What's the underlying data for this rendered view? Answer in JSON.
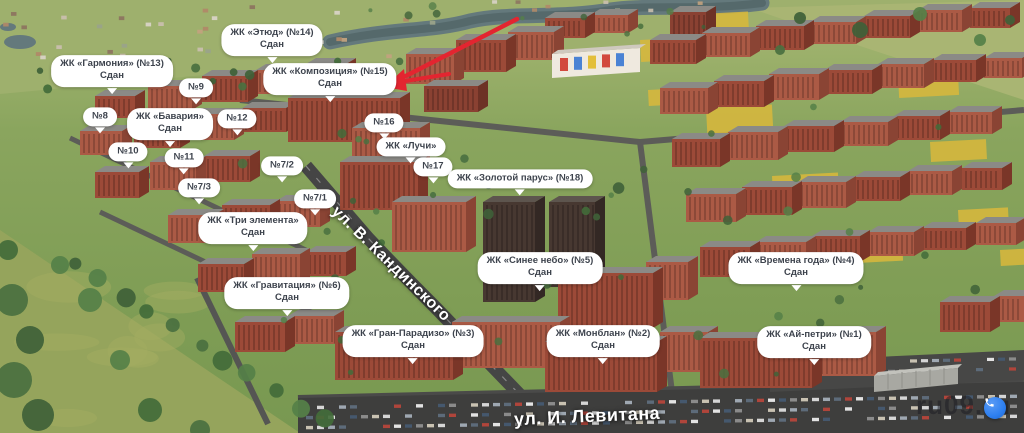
{
  "map": {
    "streets": {
      "kandinskogo": "ул. В. Кандинского",
      "levitana": "ул. И. Левитана"
    },
    "watermark": "ru09.ru",
    "annotation": {
      "arrow_color": "#e32530",
      "arrow_points_to": "ЖК «Композиция» (№15)"
    },
    "phone_button": {
      "icon": "phone-icon",
      "color": "#2d7ff0"
    },
    "bubble_color": "#ffffff",
    "labels": [
      {
        "id": "zhk-etyud",
        "x": 272,
        "y": 40,
        "lines": [
          "ЖК «Этюд» (№14)",
          "Сдан"
        ]
      },
      {
        "id": "zhk-garmoniya",
        "x": 112,
        "y": 71,
        "lines": [
          "ЖК «Гармония» (№13)",
          "Сдан"
        ]
      },
      {
        "id": "zhk-kompozitsiya",
        "x": 330,
        "y": 79,
        "lines": [
          "ЖК «Композиция» (№15)",
          "Сдан"
        ]
      },
      {
        "id": "n9",
        "x": 196,
        "y": 88,
        "lines": [
          "№9"
        ]
      },
      {
        "id": "n8",
        "x": 100,
        "y": 117,
        "lines": [
          "№8"
        ]
      },
      {
        "id": "zhk-bavariya",
        "x": 170,
        "y": 124,
        "lines": [
          "ЖК «Бавария»",
          "Сдан"
        ]
      },
      {
        "id": "n12",
        "x": 237,
        "y": 119,
        "lines": [
          "№12"
        ]
      },
      {
        "id": "n16",
        "x": 384,
        "y": 123,
        "lines": [
          "№16"
        ]
      },
      {
        "id": "zhk-luchi",
        "x": 411,
        "y": 147,
        "lines": [
          "ЖК «Лучи»"
        ]
      },
      {
        "id": "n10",
        "x": 128,
        "y": 152,
        "lines": [
          "№10"
        ]
      },
      {
        "id": "n11",
        "x": 184,
        "y": 158,
        "lines": [
          "№11"
        ]
      },
      {
        "id": "n7-2",
        "x": 282,
        "y": 166,
        "lines": [
          "№7/2"
        ]
      },
      {
        "id": "n17",
        "x": 433,
        "y": 167,
        "lines": [
          "№17"
        ]
      },
      {
        "id": "zhk-zolotoy-parus",
        "x": 520,
        "y": 179,
        "lines": [
          "ЖК «Золотой парус» (№18)"
        ]
      },
      {
        "id": "n7-3",
        "x": 199,
        "y": 188,
        "lines": [
          "№7/3"
        ]
      },
      {
        "id": "n7-1",
        "x": 315,
        "y": 199,
        "lines": [
          "№7/1"
        ]
      },
      {
        "id": "zhk-tri-elementa",
        "x": 253,
        "y": 228,
        "lines": [
          "ЖК «Три элемента»",
          "Сдан"
        ]
      },
      {
        "id": "zhk-sinee-nebo",
        "x": 540,
        "y": 268,
        "lines": [
          "ЖК «Синее небо» (№5)",
          "Сдан"
        ]
      },
      {
        "id": "zhk-vremena-goda",
        "x": 796,
        "y": 268,
        "lines": [
          "ЖК «Времена года» (№4)",
          "Сдан"
        ]
      },
      {
        "id": "zhk-gravitatsiya",
        "x": 287,
        "y": 293,
        "lines": [
          "ЖК «Гравитация» (№6)",
          "Сдан"
        ]
      },
      {
        "id": "zhk-gran-paradizo",
        "x": 413,
        "y": 341,
        "lines": [
          "ЖК «Гран-Парадизо» (№3)",
          "Сдан"
        ]
      },
      {
        "id": "zhk-monblan",
        "x": 603,
        "y": 341,
        "lines": [
          "ЖК «Монблан» (№2)",
          "Сдан"
        ]
      },
      {
        "id": "zhk-ay-petri",
        "x": 814,
        "y": 342,
        "lines": [
          "ЖК «Ай-петри» (№1)",
          "Сдан"
        ]
      }
    ]
  }
}
